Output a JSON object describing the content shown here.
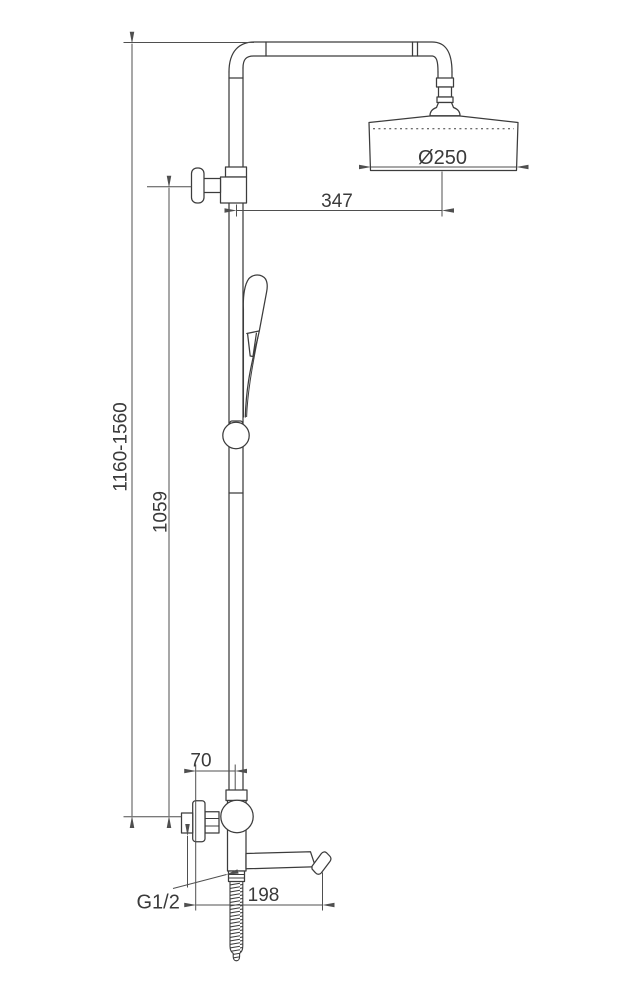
{
  "drawing": {
    "labels": {
      "overall_height": "1160-1560",
      "riser_height": "1059",
      "arm_projection": "347",
      "head_diameter": "Ø250",
      "wall_offset": "70",
      "spout_projection": "198",
      "thread_size": "G1/2"
    },
    "colors": {
      "background": "#ffffff",
      "object_line": "#3c3c3c",
      "dimension_line": "#4f4f4f",
      "text": "#3a3a3a"
    }
  }
}
